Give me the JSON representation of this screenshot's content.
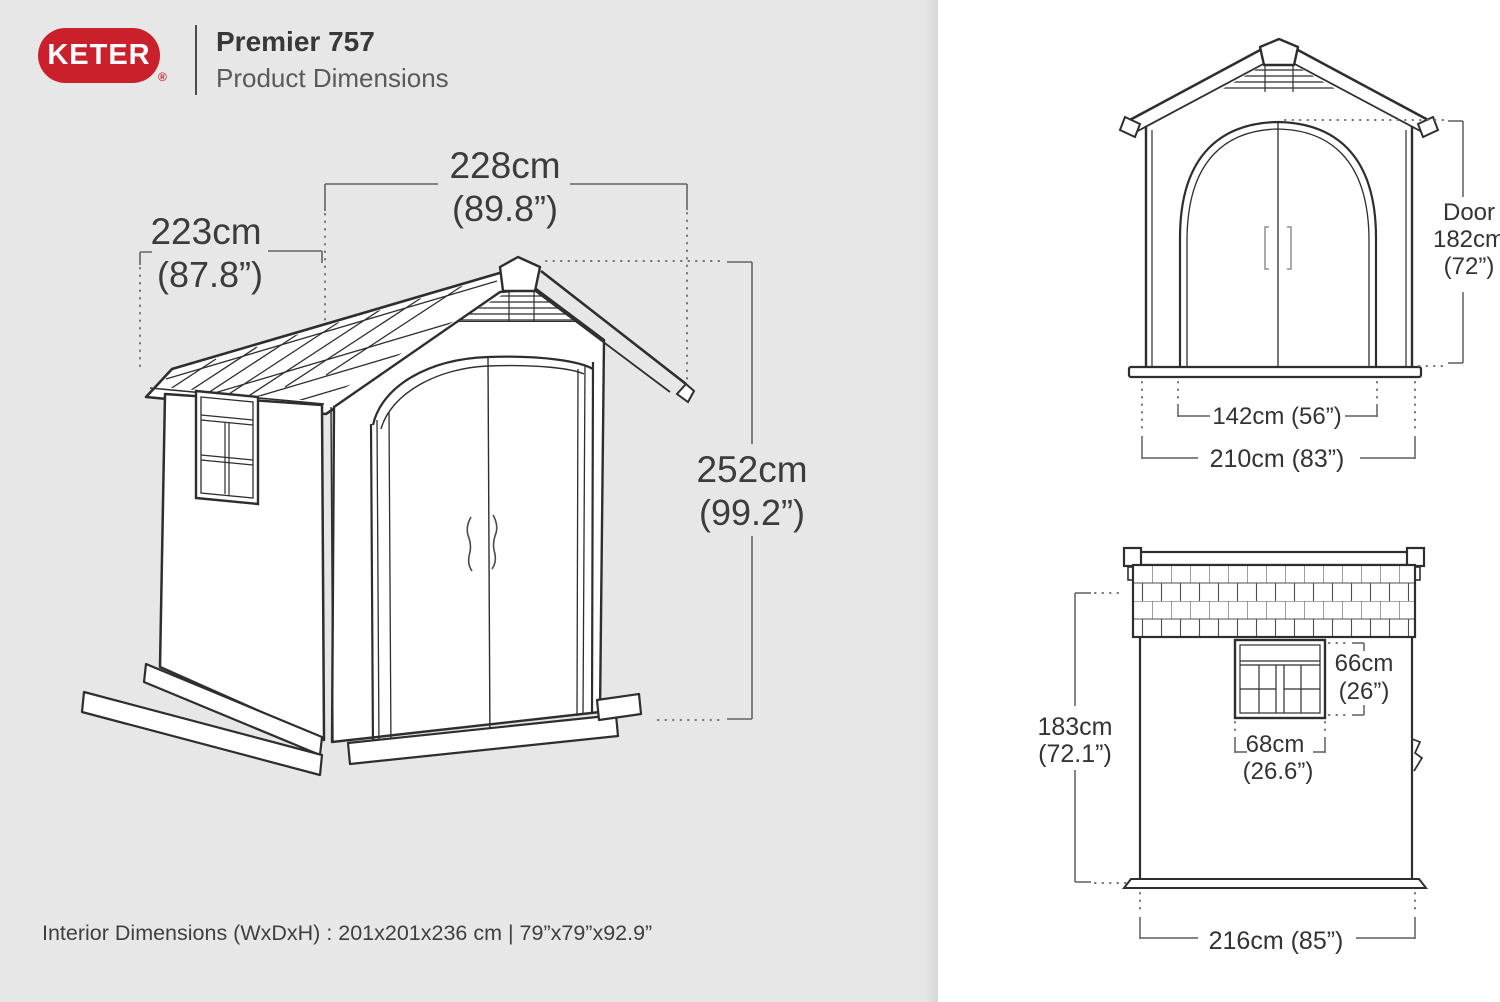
{
  "colors": {
    "panel_left_bg": "#e7e7e7",
    "panel_right_bg": "#ffffff",
    "drawing_line": "#2e2e2e",
    "dimension_line": "#646464",
    "text": "#3c3c3c",
    "brand_red": "#c9202c"
  },
  "header": {
    "brand": "KETER",
    "registered_mark": "®",
    "title": "Premier 757",
    "subtitle": "Product Dimensions"
  },
  "isometric_view": {
    "width_cm": "228cm",
    "width_in": "(89.8”)",
    "depth_cm": "223cm",
    "depth_in": "(87.8”)",
    "height_cm": "252cm",
    "height_in": "(99.2”)"
  },
  "front_view": {
    "door_label": "Door",
    "door_height_cm": "182cm",
    "door_height_in": "(72”)",
    "door_width": "142cm (56”)",
    "overall_width": "210cm (83”)"
  },
  "side_view": {
    "wall_height_cm": "183cm",
    "wall_height_in": "(72.1”)",
    "window_height_cm": "66cm",
    "window_height_in": "(26”)",
    "window_width_cm": "68cm",
    "window_width_in": "(26.6”)",
    "overall_depth": "216cm (85”)"
  },
  "footer": {
    "interior_dimensions": "Interior Dimensions (WxDxH) : 201x201x236 cm | 79”x79”x92.9”"
  }
}
